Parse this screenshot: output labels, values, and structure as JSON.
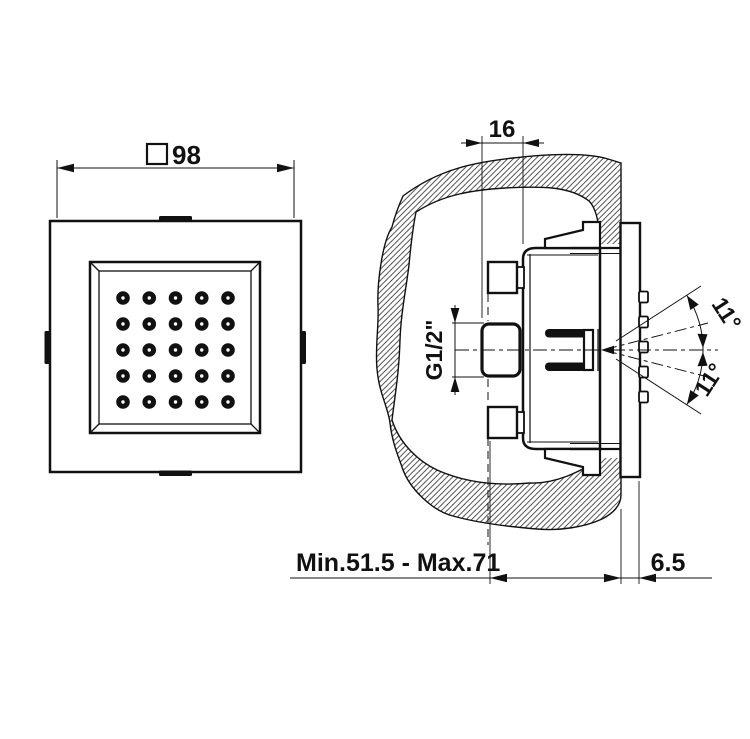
{
  "colors": {
    "ink": "#111111",
    "background": "#ffffff"
  },
  "front_view": {
    "width_dim": {
      "symbol": "□",
      "value": "98"
    },
    "nozzle_grid": {
      "rows": 5,
      "cols": 5
    }
  },
  "side_view": {
    "embed_depth_dim": "16",
    "thread_label": "G1/2\"",
    "angle_upper": "11°",
    "angle_lower": "11°",
    "depth_range_dim": "Min.51.5 - Max.71",
    "plate_offset_dim": "6.5",
    "adjustment_ribs": 5
  }
}
